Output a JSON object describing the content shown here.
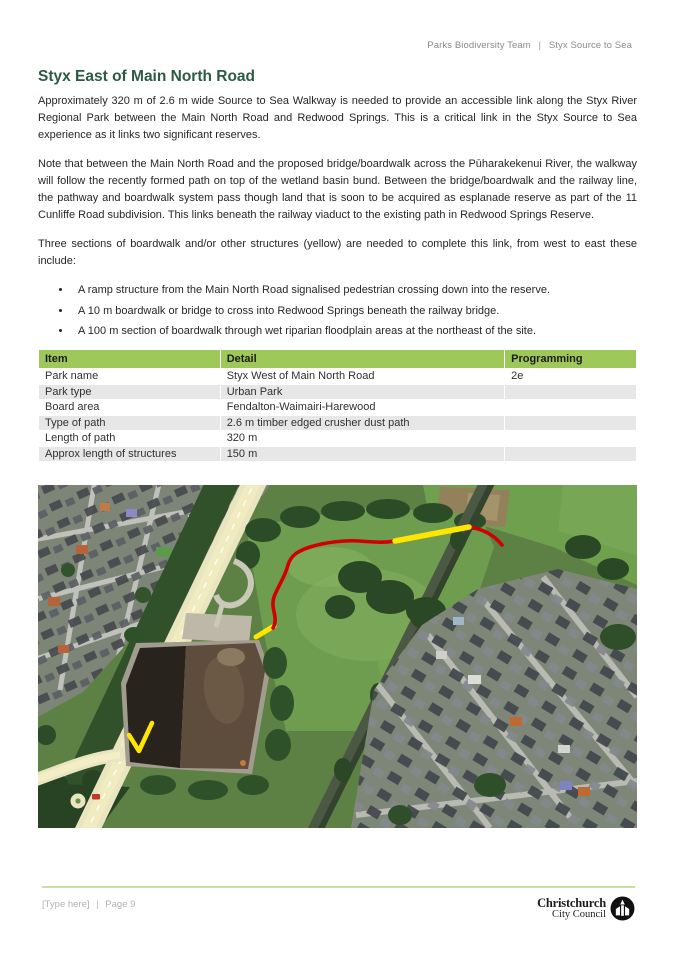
{
  "page": {
    "header": {
      "team": "Parks Biodiversity Team",
      "divider": "|",
      "project": "Styx Source to Sea"
    },
    "title": "Styx East of Main North Road",
    "paragraphs": {
      "p1": "Approximately 320 m of 2.6 m wide Source to Sea Walkway is needed to provide an accessible link along the Styx River Regional Park between the Main North Road and Redwood Springs. This is a critical link in the Styx Source to Sea experience as it links two significant reserves.",
      "p2": "Note that between the Main North Road and the proposed bridge/boardwalk across the Pūharakekenui River, the walkway will follow the recently formed path on top of the wetland basin bund. Between the bridge/boardwalk and the railway line, the pathway and boardwalk system pass though land that is soon to be acquired as esplanade reserve as part of the 11 Cunliffe Road subdivision. This links beneath the railway viaduct to the existing path in Redwood Springs Reserve.",
      "p3": "Three sections of boardwalk and/or other structures (yellow) are needed to complete this link, from west to east these include:"
    },
    "bullets": [
      "A ramp structure from the Main North Road signalised pedestrian crossing down into the reserve.",
      "A 10 m boardwalk or bridge to cross into Redwood Springs beneath the railway bridge.",
      "A 100 m section of boardwalk through wet riparian floodplain areas at the northeast of the site."
    ],
    "table": {
      "headers": [
        "Item",
        "Detail",
        "Programming"
      ],
      "rows": [
        [
          "Park name",
          "Styx West of Main North Road",
          "2e"
        ],
        [
          "Park type",
          "Urban Park",
          ""
        ],
        [
          "Board area",
          "Fendalton-Waimairi-Harewood",
          ""
        ],
        [
          "Type of path",
          "2.6 m timber edged crusher dust path",
          ""
        ],
        [
          "Length of path",
          "320 m",
          ""
        ],
        [
          "Approx length of structures",
          "150 m",
          ""
        ]
      ]
    },
    "map": {
      "description": "Aerial photo of site with proposed walkway (red) and structure sections (yellow)",
      "colors": {
        "proposed_structures_yellow": "#ffe600",
        "proposed_path_red": "#d10000"
      }
    },
    "footer": {
      "type_here": "[Type here]",
      "divider": "|",
      "page_number": "Page 9",
      "logo_line1": "Christchurch",
      "logo_line2": "City Council"
    }
  },
  "colors": {
    "table_header_green": "#9ec859",
    "heading_green": "#2d5a44",
    "footer_rule_green": "#c9e0a4"
  }
}
